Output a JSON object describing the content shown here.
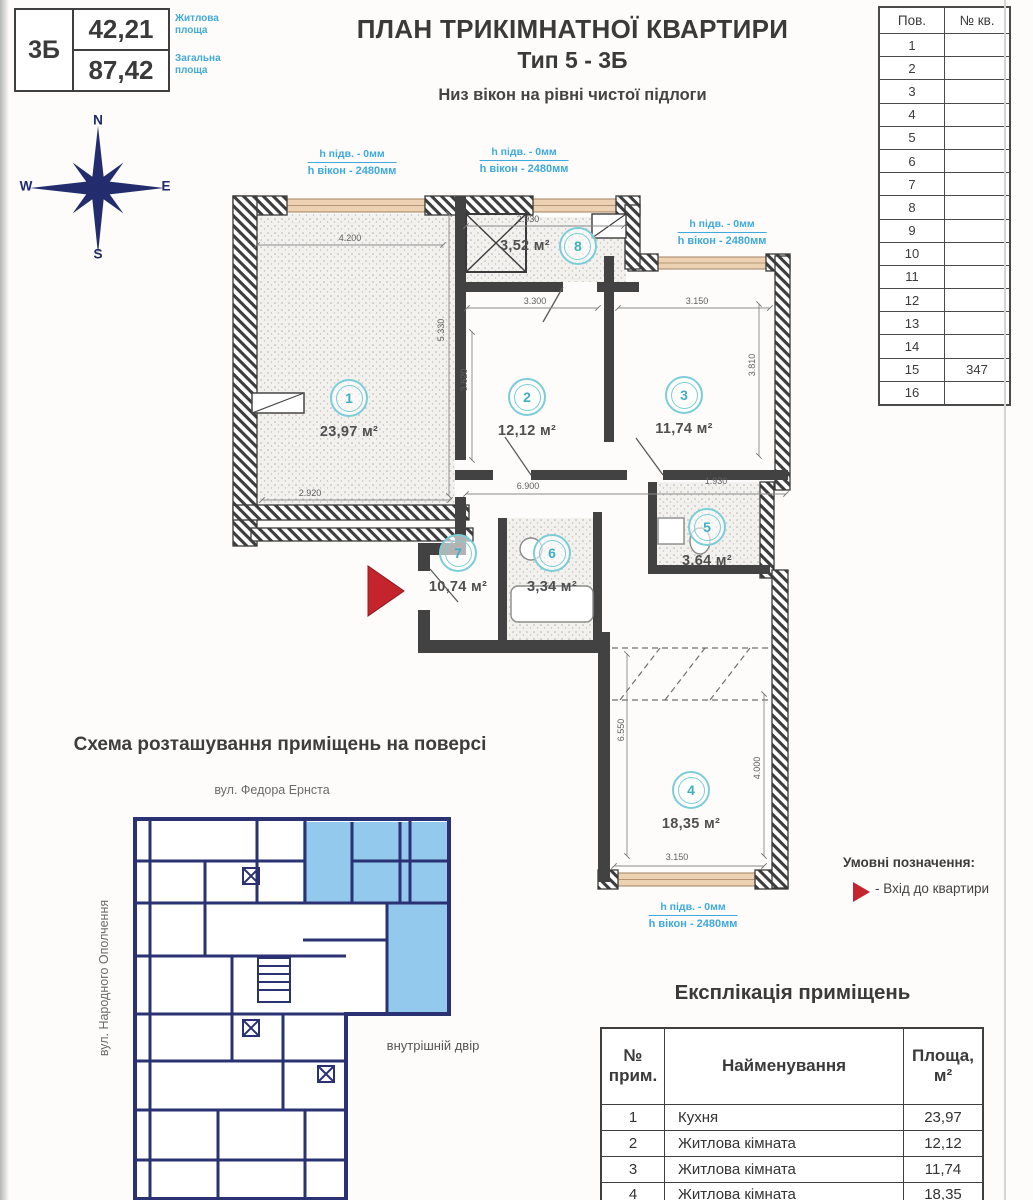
{
  "header": {
    "info_box": {
      "type": "3Б",
      "living_area": "42,21",
      "total_area": "87,42",
      "living_label": "Житлова площа",
      "total_label": "Загальна площа"
    },
    "title": "ПЛАН ТРИКІМНАТНОЇ КВАРТИРИ",
    "subtitle": "Тип 5 - 3Б",
    "note": "Низ вікон на рівні чистої підлоги"
  },
  "floors_table": {
    "col_floor": "Пов.",
    "col_apt": "№ кв.",
    "rows": [
      {
        "floor": "1",
        "apt": ""
      },
      {
        "floor": "2",
        "apt": ""
      },
      {
        "floor": "3",
        "apt": ""
      },
      {
        "floor": "4",
        "apt": ""
      },
      {
        "floor": "5",
        "apt": ""
      },
      {
        "floor": "6",
        "apt": ""
      },
      {
        "floor": "7",
        "apt": ""
      },
      {
        "floor": "8",
        "apt": ""
      },
      {
        "floor": "9",
        "apt": ""
      },
      {
        "floor": "10",
        "apt": ""
      },
      {
        "floor": "11",
        "apt": ""
      },
      {
        "floor": "12",
        "apt": ""
      },
      {
        "floor": "13",
        "apt": ""
      },
      {
        "floor": "14",
        "apt": ""
      },
      {
        "floor": "15",
        "apt": "347"
      },
      {
        "floor": "16",
        "apt": ""
      }
    ]
  },
  "compass": {
    "n": "N",
    "s": "S",
    "e": "E",
    "w": "W"
  },
  "plan": {
    "rooms": [
      {
        "num": "1",
        "area": "23,97 м²"
      },
      {
        "num": "2",
        "area": "12,12 м²"
      },
      {
        "num": "3",
        "area": "11,74 м²"
      },
      {
        "num": "4",
        "area": "18,35 м²"
      },
      {
        "num": "5",
        "area": "3,64 м²"
      },
      {
        "num": "6",
        "area": "3,34 м²"
      },
      {
        "num": "7",
        "area": "10,74 м²"
      },
      {
        "num": "8",
        "area": "3,52 м²"
      }
    ],
    "window_label": {
      "line1": "h підв. - 0мм",
      "line2": "h вікон - 2480мм"
    },
    "dims": [
      "4.200",
      "2.930",
      "3.300",
      "3.150",
      "5.330",
      "3.620",
      "2.920",
      "6.900",
      "3.810",
      "1.930",
      "6.550",
      "4.000",
      "3.150"
    ]
  },
  "schema": {
    "title": "Схема розташування приміщень на поверсі",
    "street_top": "вул. Федора Ернста",
    "street_left": "вул. Народного Ополчення",
    "courtyard": "внутрішній двір"
  },
  "legend": {
    "title": "Умовні позначення:",
    "entrance_label": "- Вхід до квартири"
  },
  "explication": {
    "title": "Експлікація приміщень",
    "col_num_l1": "№",
    "col_num_l2": "прим.",
    "col_name": "Найменування",
    "col_area_l1": "Площа,",
    "col_area_l2": "м²",
    "rows": [
      {
        "num": "1",
        "name": "Кухня",
        "area": "23,97"
      },
      {
        "num": "2",
        "name": "Житлова кімната",
        "area": "12,12"
      },
      {
        "num": "3",
        "name": "Житлова кімната",
        "area": "11,74"
      },
      {
        "num": "4",
        "name": "Житлова кімната",
        "area": "18,35"
      }
    ]
  },
  "colors": {
    "accent_blue": "#3fa8dc",
    "teal": "#7ccdd8",
    "navy": "#2a3273",
    "red": "#c4242b",
    "window_tan": "#ecd2b2"
  }
}
